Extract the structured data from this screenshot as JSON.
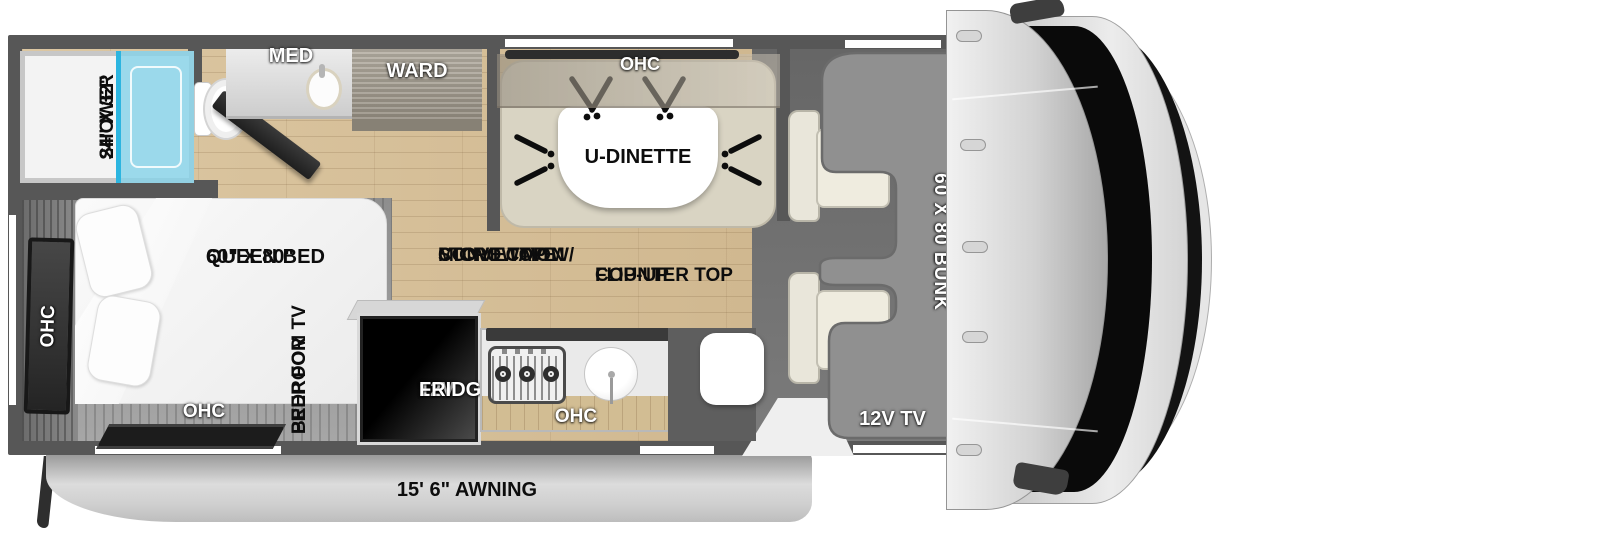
{
  "title": "RV floorplan with cab-over bunk",
  "colors": {
    "wall": "#575757",
    "wood_floor": "#d6bf9a",
    "shower_glass": "#7fd2ec",
    "bunk_gray": "#909090",
    "fridge_black": "#000000",
    "label_light": "#ffffff",
    "label_dark": "#0d0d0d"
  },
  "bathroom": {
    "shower_size": "24\" X 32\"",
    "shower": "SHOWER",
    "med": "MED",
    "ward": "WARD"
  },
  "dinette": {
    "ohc": "OHC",
    "label": "U-DINETTE"
  },
  "bedroom": {
    "size": "60\" X 80\"",
    "bed": "QUEEN BED",
    "ohc_side": "OHC",
    "ohc_foot": "OHC",
    "prep1": "PREP FOR",
    "prep2": "BEDROOM TV"
  },
  "kitchen": {
    "fridge1": "12V",
    "fridge2": "FRIDGE",
    "stove1": "STOVE TOP W/",
    "stove2": "CONVECTION",
    "stove3": "MICROWAVE",
    "flip1": "FLIP-UP",
    "flip2": "COUNTER TOP",
    "ohc": "OHC"
  },
  "front": {
    "bunk": "60 X 80 BUNK",
    "tv": "12V TV"
  },
  "exterior": {
    "awning": "15' 6\" AWNING"
  }
}
